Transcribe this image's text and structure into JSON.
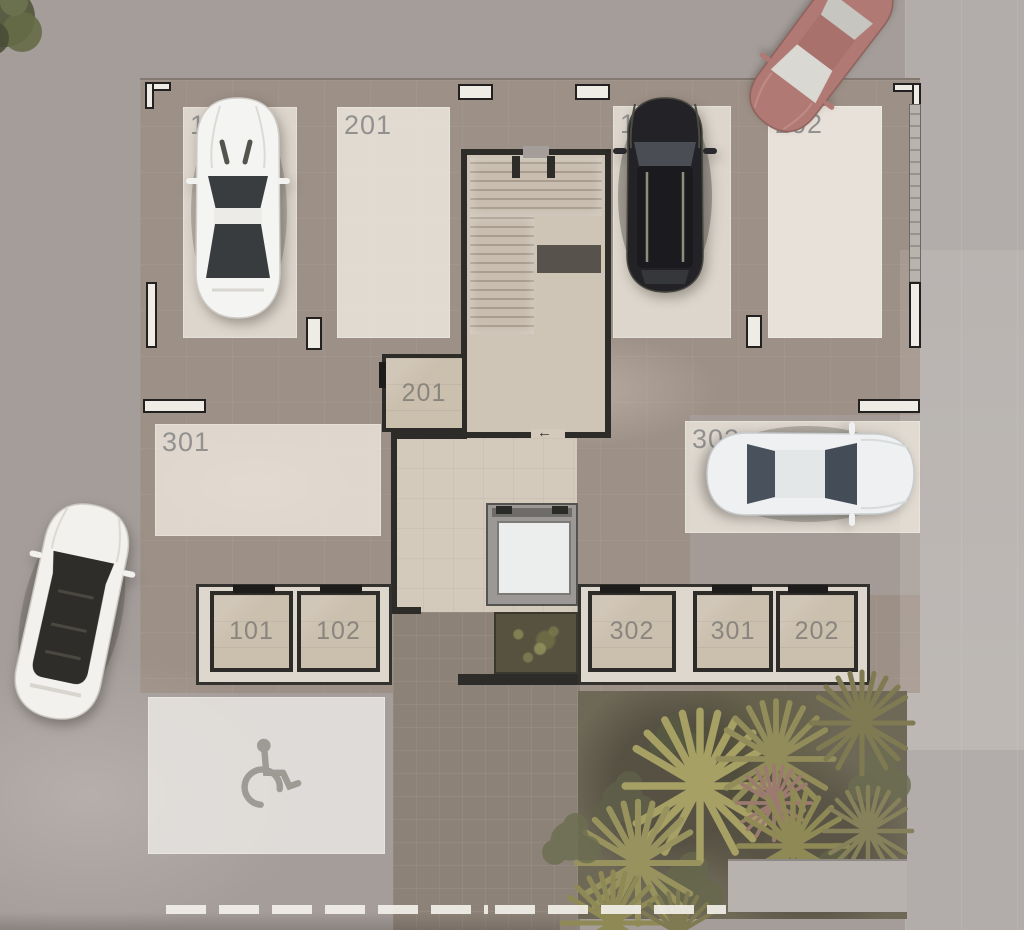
{
  "plan": {
    "description": "Top-down 3D rendered floor plan of a residential parking level with numbered parking spaces, storage rooms, central staircase, elevator and garden",
    "parking_spaces": [
      {
        "id": "p101",
        "label": "101",
        "row": "top",
        "occupied_by": "white-coupe"
      },
      {
        "id": "p201",
        "label": "201",
        "row": "top",
        "occupied_by": null
      },
      {
        "id": "p102",
        "label": "102",
        "row": "top",
        "occupied_by": "black-suv"
      },
      {
        "id": "p202",
        "label": "202",
        "row": "top",
        "occupied_by": null
      },
      {
        "id": "p301",
        "label": "301",
        "row": "middle-left",
        "occupied_by": null
      },
      {
        "id": "p302",
        "label": "302",
        "row": "middle-right",
        "occupied_by": "white-sedan"
      }
    ],
    "accessible_space": {
      "id": "p-accessible",
      "label": "",
      "symbol": "wheelchair",
      "row": "bottom-left"
    },
    "storage_rooms": [
      {
        "id": "s201",
        "label": "201",
        "location": "beside staircase"
      },
      {
        "id": "s101",
        "label": "101",
        "location": "bottom-left block"
      },
      {
        "id": "s102",
        "label": "102",
        "location": "bottom-left block"
      },
      {
        "id": "s302",
        "label": "302",
        "location": "bottom-right block"
      },
      {
        "id": "s301",
        "label": "301",
        "location": "bottom-right block"
      },
      {
        "id": "s202",
        "label": "202",
        "location": "bottom-right block"
      }
    ],
    "vehicles": [
      {
        "name": "white-coupe",
        "color": "#f4f4f2",
        "location": "parking space 101"
      },
      {
        "name": "black-suv",
        "color": "#232327",
        "location": "parking space 102"
      },
      {
        "name": "red-sedan",
        "color": "#b07973",
        "location": "driveway top-right, angled"
      },
      {
        "name": "white-sedan",
        "color": "#eef0f1",
        "location": "parking space 302"
      },
      {
        "name": "white-suv",
        "color": "#f2f1ee",
        "location": "driveway bottom-left, angled"
      }
    ],
    "features": {
      "staircase": "central staircase core",
      "elevator": "elevator shaft south of staircase",
      "shrub_planter": "planter beside elevator",
      "garden": "garden with palm trees bottom-right",
      "tree": "tree canopy top-left corner",
      "exit_arrow": "←"
    },
    "colors": {
      "asphalt": "#a49d9a",
      "interior_concrete": "#9d9087",
      "parking_pad": "#f0e9df",
      "storage_floor": "#cbbfae",
      "wall_dark": "#2e2c29",
      "wall_light": "#efece6",
      "walkway": "#8c8278",
      "garden_green": "#6e6857",
      "label_text": "#8a8a8a",
      "elevator_cab": "#eceded",
      "accent_car_red": "#b07973"
    }
  }
}
